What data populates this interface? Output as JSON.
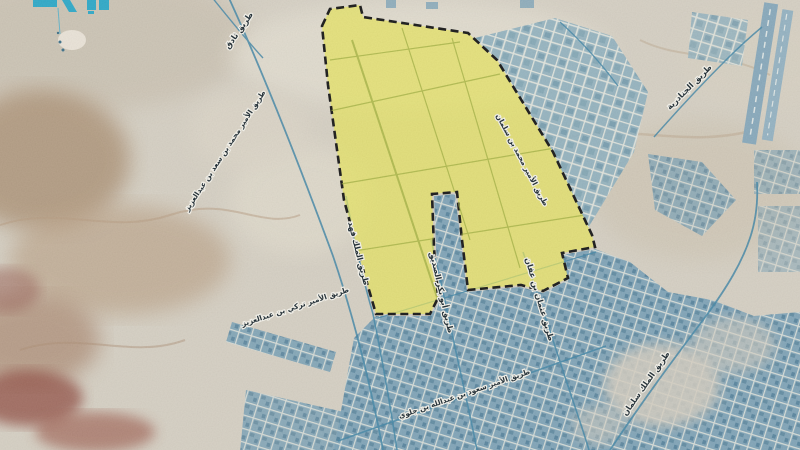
{
  "map": {
    "kind": "satellite-map-infographic",
    "zone": {
      "name": "highlighted-development-zone",
      "fill": "#e7e557",
      "border_style": "black-dashed"
    },
    "colors": {
      "desert": "#d6d0c3",
      "urban": "#79a1b6",
      "roads": "#3f85a6",
      "label_text": "#15232b",
      "label_halo": "#f6f4ec",
      "watermark": "#2aa8c8"
    },
    "watermark": {
      "name": "partial-teal-logo",
      "note_color": "#2aa8c8"
    },
    "road_labels": [
      {
        "id": "tariq-thadig",
        "text": "طريق ثادق"
      },
      {
        "id": "prince-mohammed-bin-saad",
        "text": "طريق الأمير محمد بن سعد بن عبدالعزيز"
      },
      {
        "id": "king-fahd",
        "text": "طريق الملك فهد"
      },
      {
        "id": "prince-turki",
        "text": "طريق الأمير تركي بن عبدالعزيز"
      },
      {
        "id": "abu-bakr-al-siddiq",
        "text": "طريق أبو بكر الصديق"
      },
      {
        "id": "othman-bin-affan",
        "text": "طريق عثمان بن عفان"
      },
      {
        "id": "prince-mohammed-bin-salman",
        "text": "طريق الأمير محمد بن سلمان"
      },
      {
        "id": "prince-saud-bin-abdullah",
        "text": "طريق الأمير سعود بن عبدالله بن جلوي"
      },
      {
        "id": "king-salman",
        "text": "طريق الملك سلمان"
      },
      {
        "id": "janadriyah",
        "text": "طريق الجنادرية"
      }
    ]
  }
}
